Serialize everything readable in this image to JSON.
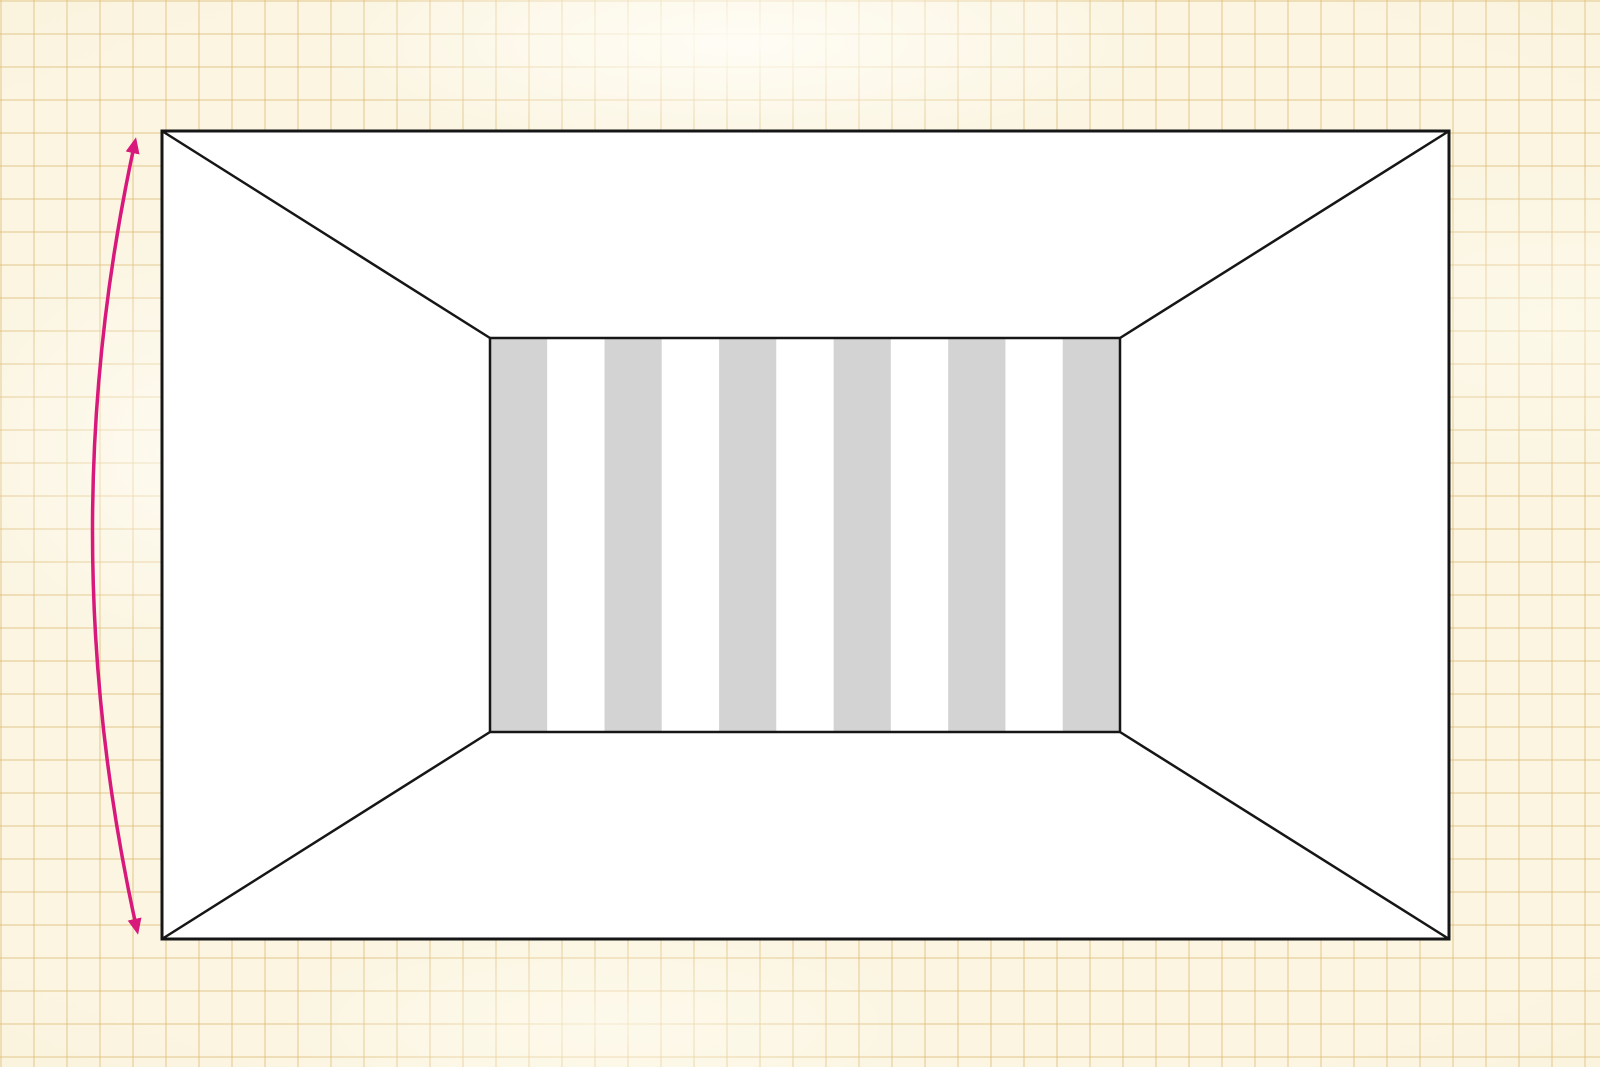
{
  "canvas": {
    "width": 1600,
    "height": 1067,
    "paper_color": "#fbf5e2",
    "grid_line_color": "rgba(219,186,115,0.40)",
    "grid_cell_size": 33
  },
  "figure": {
    "kind": "one-point-perspective room with striped back wall and height-extent arrow",
    "line_color": "#161616",
    "outer_rect": {
      "x": 162,
      "y": 131,
      "width": 1287,
      "height": 808,
      "fill": "#ffffff",
      "stroke_width": 3
    },
    "back_wall": {
      "x": 490,
      "y": 338,
      "width": 630,
      "height": 394,
      "fill": "#ffffff",
      "stroke_width": 2.5
    },
    "stripes": {
      "count": 11,
      "orientation": "vertical",
      "gray_color": "#d3d3d3",
      "white_color": "#ffffff",
      "edge_stripes": "gray"
    },
    "diagonals": {
      "stroke_width": 2.5,
      "lines": [
        {
          "x1": 162,
          "y1": 131,
          "x2": 490,
          "y2": 338
        },
        {
          "x1": 1449,
          "y1": 131,
          "x2": 1120,
          "y2": 338
        },
        {
          "x1": 162,
          "y1": 939,
          "x2": 490,
          "y2": 732
        },
        {
          "x1": 1449,
          "y1": 939,
          "x2": 1120,
          "y2": 732
        }
      ]
    },
    "height_arrow": {
      "color": "#d8187b",
      "stroke_width": 3.5,
      "heads": "both",
      "start": {
        "x": 135,
        "y": 142
      },
      "control": {
        "x": 49,
        "y": 535
      },
      "end": {
        "x": 137,
        "y": 930
      }
    }
  }
}
